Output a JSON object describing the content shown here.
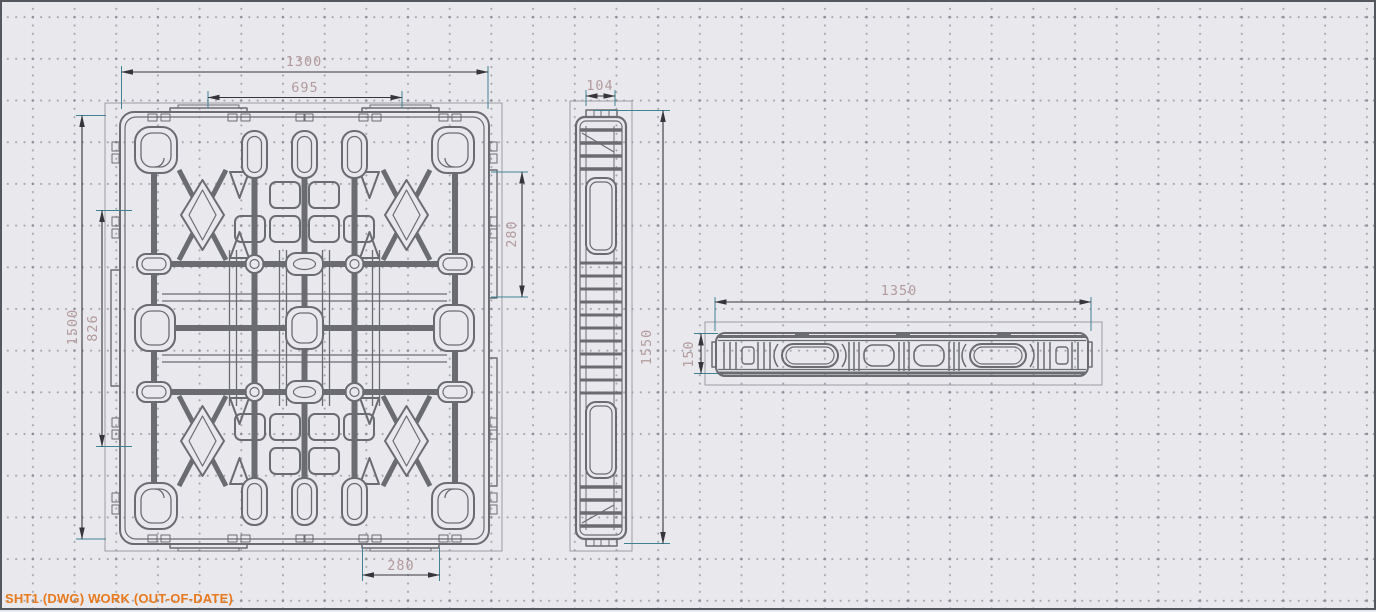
{
  "status_bar": {
    "text": "SHT1 (DWG) WORK (OUT-OF-DATE)"
  },
  "drawing": {
    "description": "three-view engineering drawing of a plastic pallet",
    "views": {
      "plan": {
        "label": "plan view",
        "dims": {
          "overall_width": "1300",
          "inner_width": "695",
          "overall_height": "1500",
          "inner_height": "826",
          "side_pocket": "280",
          "bottom_pocket": "280"
        }
      },
      "end_elevation": {
        "label": "end elevation view",
        "dims": {
          "thickness": "104",
          "overall_height": "1550"
        }
      },
      "front_elevation": {
        "label": "front elevation view",
        "dims": {
          "overall_length": "1350",
          "height": "150"
        }
      }
    }
  },
  "colors": {
    "background": "#e9e9ed",
    "grid_dot": "#a6a6b0",
    "grid_node": "#8d8d97",
    "geometry": "#6b6b72",
    "viewport_border": "#9b9ba3",
    "dimension_line": "#35353b",
    "extension_line": "#3f8296",
    "dimension_text": "#b39a9c",
    "status_text": "#e8791c",
    "frame_border": "#54585e"
  }
}
